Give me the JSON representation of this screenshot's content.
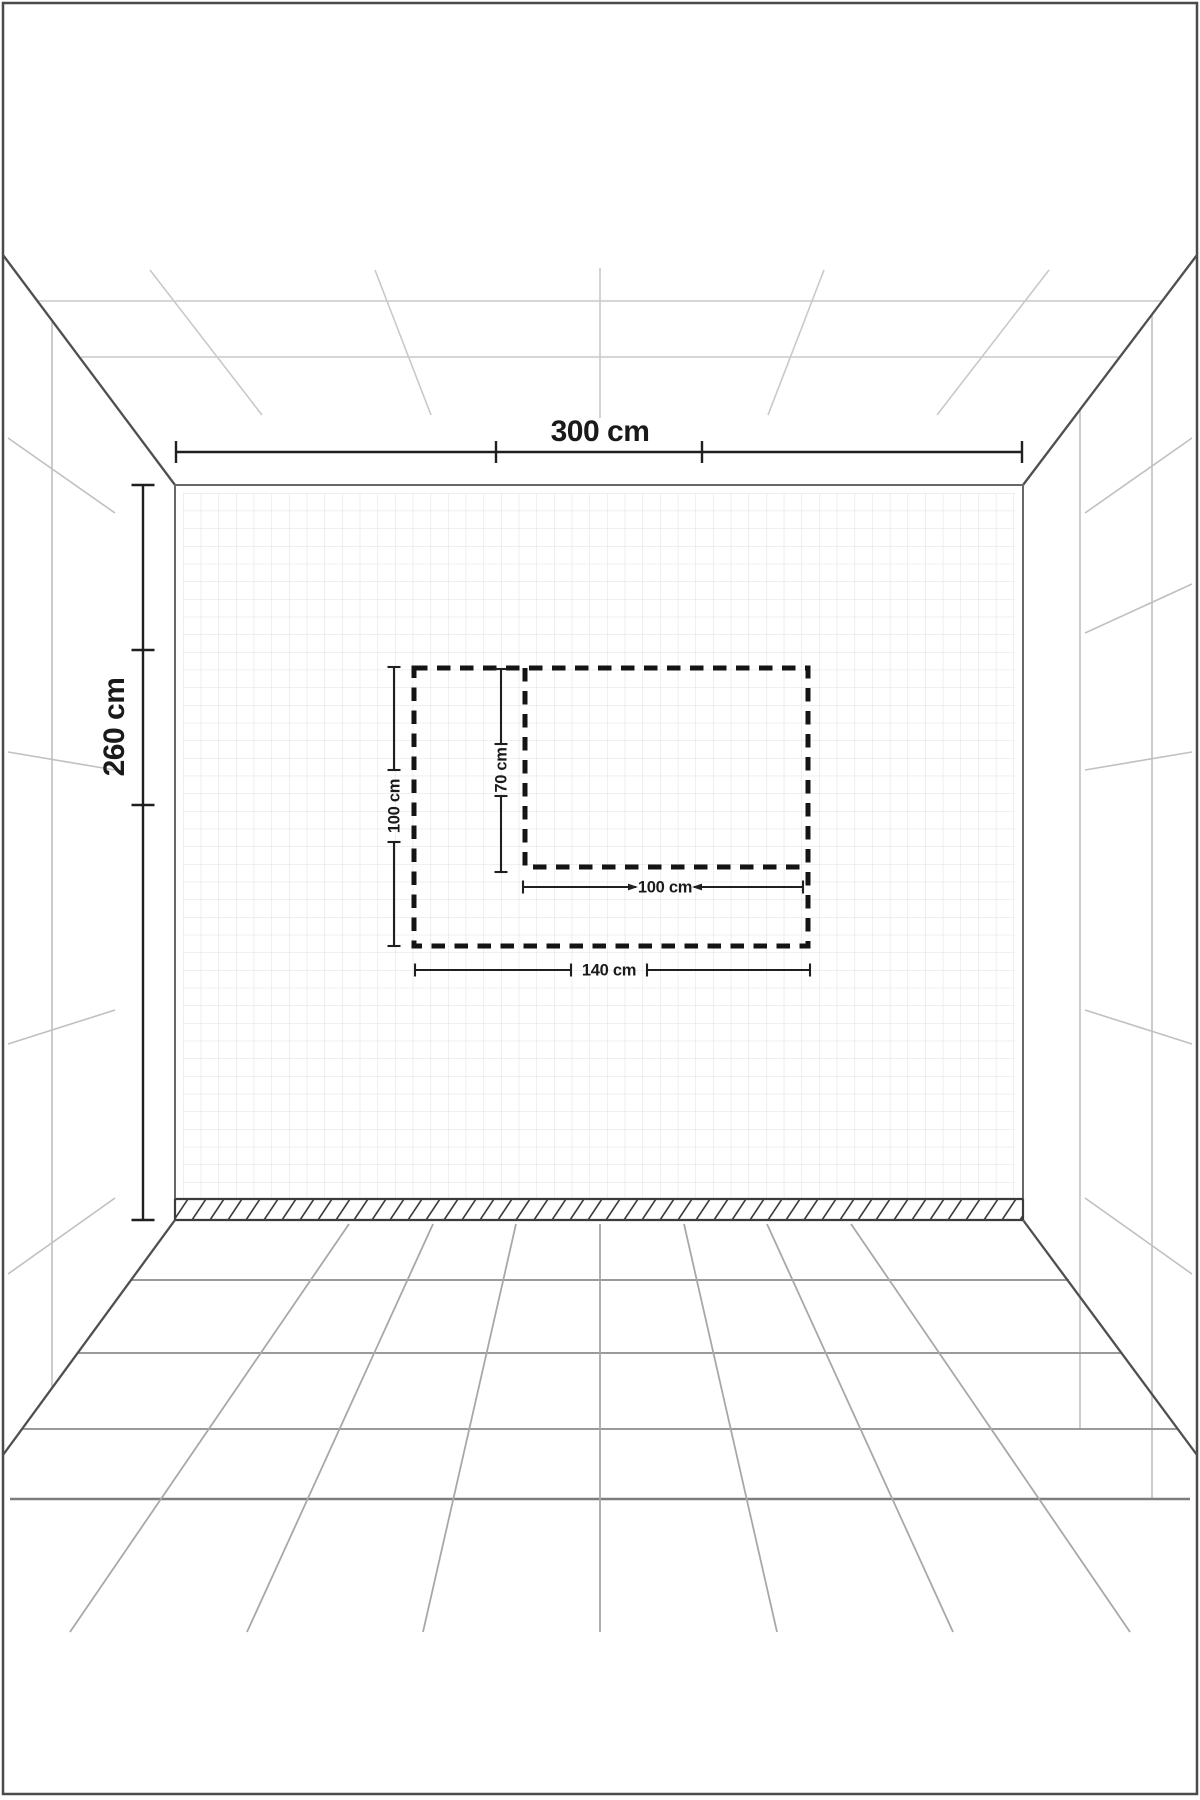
{
  "diagram": {
    "kind": "perspective-room-wall-dimension-diagram",
    "wall": {
      "width_label": "300 cm",
      "height_label": "260 cm"
    },
    "outer_panel": {
      "width_label": "140 cm",
      "height_label": "100 cm"
    },
    "inner_panel": {
      "width_label": "100 cm",
      "height_label": "70 cm"
    },
    "colors": {
      "background": "#ffffff",
      "frame": "#4a4a4a",
      "room_edge": "#4f4f4f",
      "ceiling_grid": "#c9c9c9",
      "side_wall_grid": "#c0c0c0",
      "floor_grid": "#9a9a9a",
      "wall_grid": "#e1e1e1",
      "skirting": "#3c3c3c",
      "dimension": "#1f1f1f",
      "dashed_outline": "#141414"
    }
  }
}
